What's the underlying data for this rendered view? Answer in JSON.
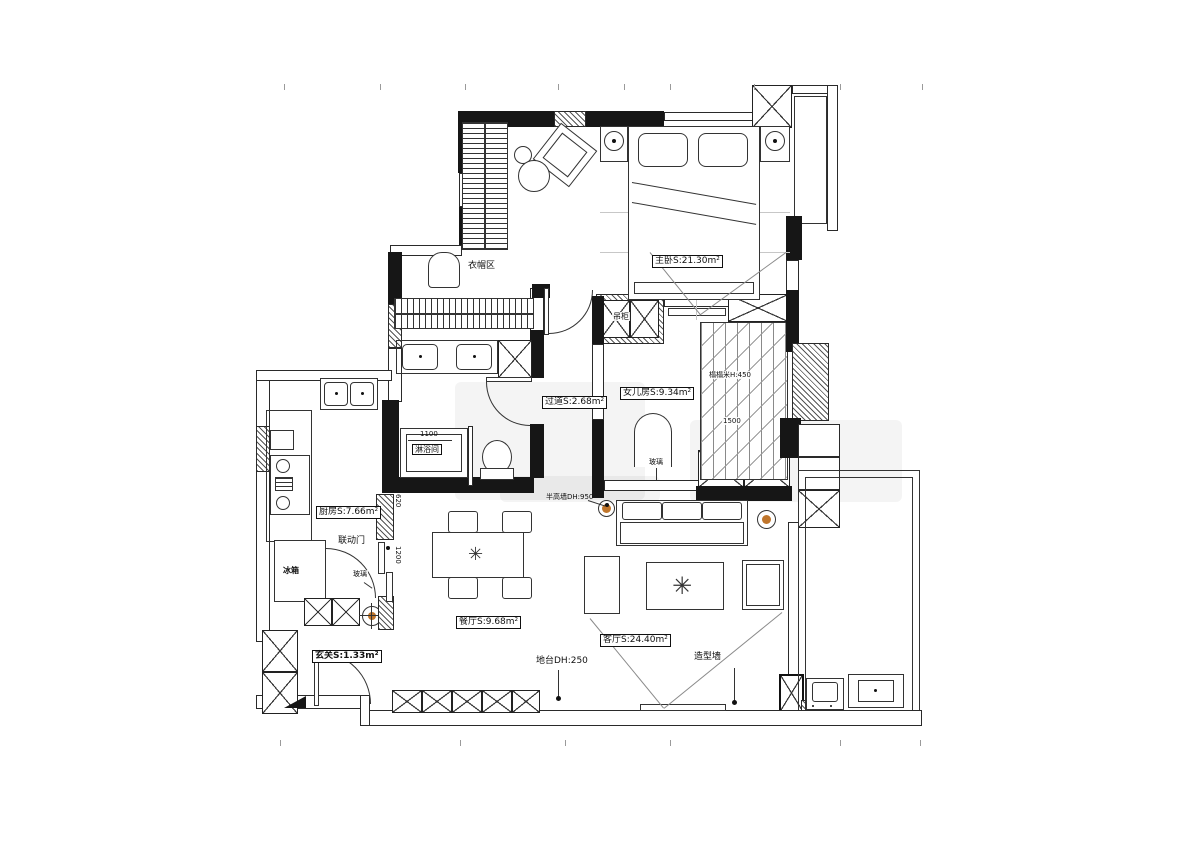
{
  "title": "三室户型平面布置图",
  "colors": {
    "line": "#1c1c1c",
    "wall": "#161616",
    "accent_wood": "#c0762c"
  },
  "icons": {
    "plant": "✳"
  },
  "labels": {
    "cloakroom": "衣帽区",
    "master": "主卧S:21.30m²",
    "hanging_cabinet": "吊柜",
    "kids_room": "女儿房S:9.34m²",
    "tatami": "榻榻米H:450",
    "dim_1500": "1500",
    "corridor": "过道S:2.68m²",
    "dim_1100": "1100",
    "shower_room": "淋浴间",
    "wardrobe": "衣柜",
    "glass_kids": "玻璃",
    "half_wall": "半高墙DH:950",
    "kitchen": "厨房S:7.66m²",
    "linked_door": "联动门",
    "glass_kitchen": "玻璃",
    "fridge": "冰箱",
    "dim_620": "620",
    "dim_1200": "1200",
    "dining": "餐厅S:9.68m²",
    "living": "客厅S:24.40m²",
    "feature_wall": "造型墙",
    "platform": "地台DH:250",
    "entry": "玄关S:1.33m²"
  }
}
